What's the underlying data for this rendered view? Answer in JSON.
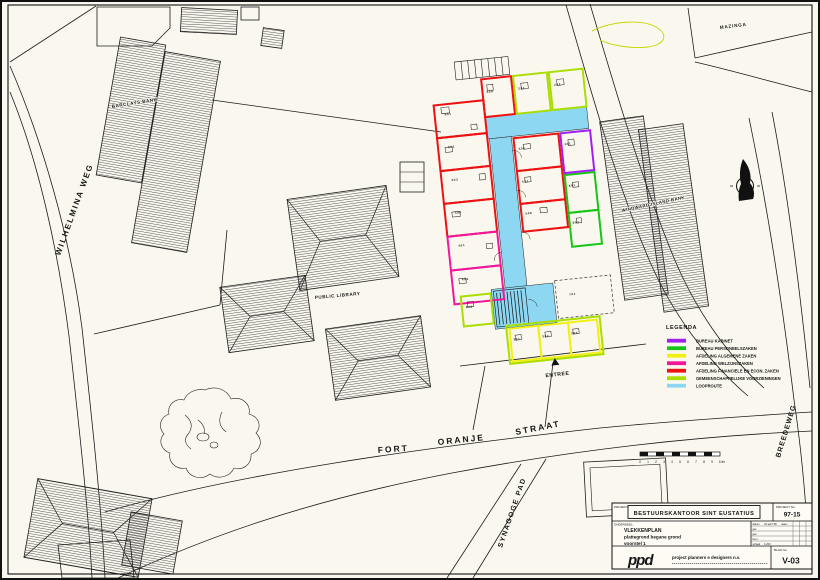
{
  "palette": {
    "paper": "#faf8ee",
    "ink": "#1b1b1b",
    "purple": "#a21ff2",
    "green": "#17c517",
    "yellow": "#f2ef13",
    "magenta": "#f2169b",
    "red": "#ee1111",
    "lime": "#aade00",
    "cyan": "#8ed7f2"
  },
  "streets": {
    "wilhelmina": "WILHELMINA WEG",
    "fort": "FORT",
    "oranje": "ORANJE",
    "straat": "STRAAT",
    "synagoge": "SYNAGOGE PAD",
    "breedeweg": "BREEDEWEG"
  },
  "places": {
    "mazinga": "MAZINGA",
    "barclays": "BARCLAYS BANK",
    "library": "PUBLIC LIBRARY",
    "windward": "WINDWARD ISLAND BANK"
  },
  "plan": {
    "entree": "ENTREE",
    "rooms": [
      {
        "code": "5.0.1"
      },
      {
        "code": "5.0.2"
      },
      {
        "code": "5.0.3"
      },
      {
        "code": "5.0.4"
      },
      {
        "code": "4.0.1"
      },
      {
        "code": "4.0.2"
      },
      {
        "code": "5.0.5"
      },
      {
        "code": "2.0.1"
      },
      {
        "code": "2.0.2"
      },
      {
        "code": "5.0.6"
      },
      {
        "code": "5.0.7"
      },
      {
        "code": "5.0.8"
      },
      {
        "code": "1.0.1"
      },
      {
        "code": "6.0.1"
      },
      {
        "code": "6.0.2"
      },
      {
        "code": "6.0.3"
      },
      {
        "code": "3.0.1"
      },
      {
        "code": "3.0.2"
      },
      {
        "code": "3.0.3"
      },
      {
        "code": "7.0.1"
      }
    ]
  },
  "legend": {
    "title": "LEGENDA",
    "items": [
      {
        "label": "BUREAU KABINET",
        "color": "#a21ff2"
      },
      {
        "label": "BUREAU PERSONEELSZAKEN",
        "color": "#17c517"
      },
      {
        "label": "AFDELING ALGEMENE ZAKEN",
        "color": "#f2ef13"
      },
      {
        "label": "AFDELING WELZIJNSZAKEN",
        "color": "#f2169b"
      },
      {
        "label": "AFDELING FINANCIELE EN ECON. ZAKEN",
        "color": "#ee1111"
      },
      {
        "label": "GEMEENSCHAPPELIJKE VOORZIENINGEN",
        "color": "#aade00"
      },
      {
        "label": "LOOPROUTE",
        "color": "#8ed7f2"
      }
    ]
  },
  "scalebar": {
    "ticks": [
      "0",
      "1",
      "2",
      "3",
      "4",
      "5",
      "6",
      "7",
      "8",
      "9",
      "10m"
    ]
  },
  "titleblock": {
    "project_label": "PROJECT:",
    "project": "BESTUURSKANTOOR SINT EUSTATIUS",
    "projectno_label": "PROJECT No.",
    "projectno": "97-15",
    "onderdeel_label": "ONDERDEEL:",
    "onderdeel1": "VLEKKENPLAN",
    "onderdeel2": "plattegrond begane grond",
    "onderdeel3": "voorstel 1",
    "info": [
      {
        "k": "datum",
        "v": "22 april '98"
      },
      {
        "k": "get.",
        "v": ""
      },
      {
        "k": "gec.",
        "v": ""
      },
      {
        "k": "form.",
        "v": ""
      },
      {
        "k": "schaal",
        "v": "1:200"
      }
    ],
    "naam": "naam",
    "logo": "ppd",
    "firm": "project planners e designers n.v.",
    "blad_label": "BLAD No.",
    "blad": "V-03"
  }
}
